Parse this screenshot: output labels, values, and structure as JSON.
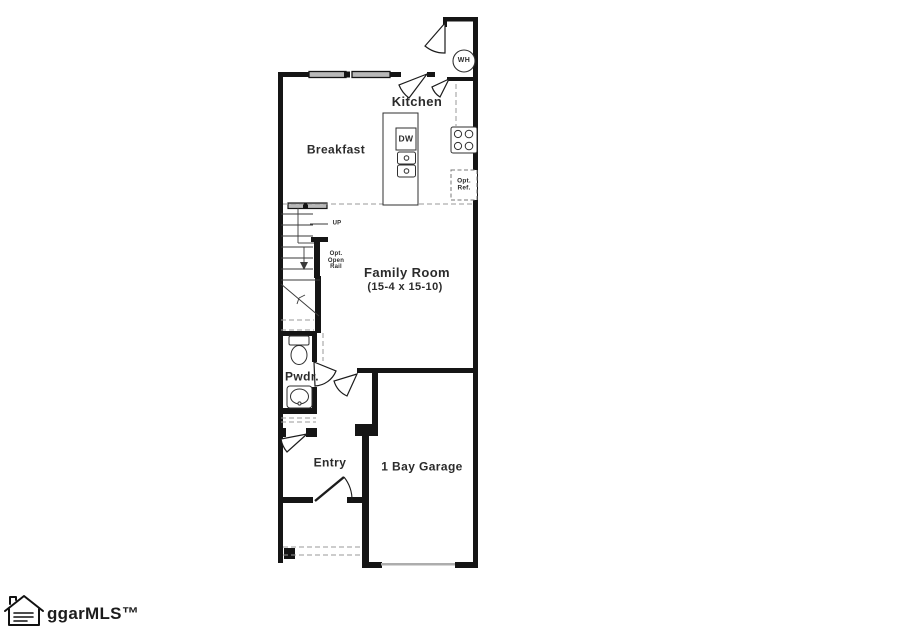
{
  "page": {
    "background": "#ffffff"
  },
  "floor_plan": {
    "rooms": {
      "kitchen": {
        "label": "Kitchen"
      },
      "breakfast": {
        "label": "Breakfast"
      },
      "family_room": {
        "label": "Family Room",
        "dimensions": "(15-4 x 15-10)"
      },
      "powder_room": {
        "label": "Pwdr."
      },
      "entry": {
        "label": "Entry"
      },
      "garage": {
        "label": "1 Bay Garage"
      }
    },
    "annotations": {
      "stairs_direction": "UP",
      "optional_open_rail": [
        "Opt.",
        "Open",
        "Rail"
      ],
      "dishwasher": "DW",
      "water_heater": "WH",
      "optional_refrigerator": [
        "Opt.",
        "Ref."
      ]
    },
    "colors": {
      "walls": "#151515",
      "window_fill": "#b9b9b9",
      "dashed_lines": "#999999",
      "text": "#2b2b2b"
    }
  },
  "watermark": {
    "brand": "ggarMLS™"
  }
}
